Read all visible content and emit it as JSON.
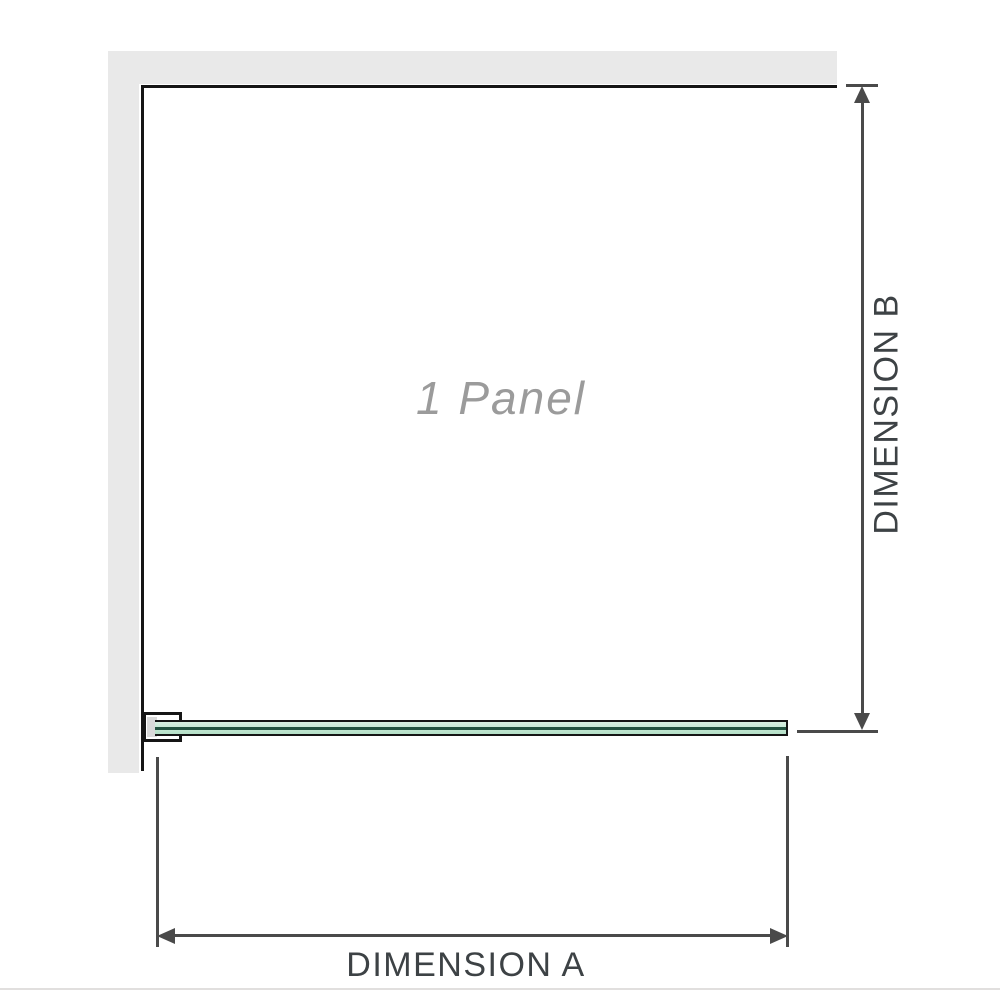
{
  "diagram": {
    "panel_label": "1 Panel",
    "dimension_a_label": "DIMENSION A",
    "dimension_b_label": "DIMENSION B"
  },
  "colors": {
    "wall": "#e9e9e9",
    "outline": "#151515",
    "dim-line": "#4a4a4a",
    "dim-text": "#3d4245",
    "panel-text": "#9b9b9b",
    "glass-light": "#d8efe1",
    "glass-dark": "#b3e0c7",
    "glass-core": "#235240",
    "bracket-fill": "#ffffff",
    "bracket-pad": "#d9d9d9",
    "divider": "#e1dfde"
  }
}
